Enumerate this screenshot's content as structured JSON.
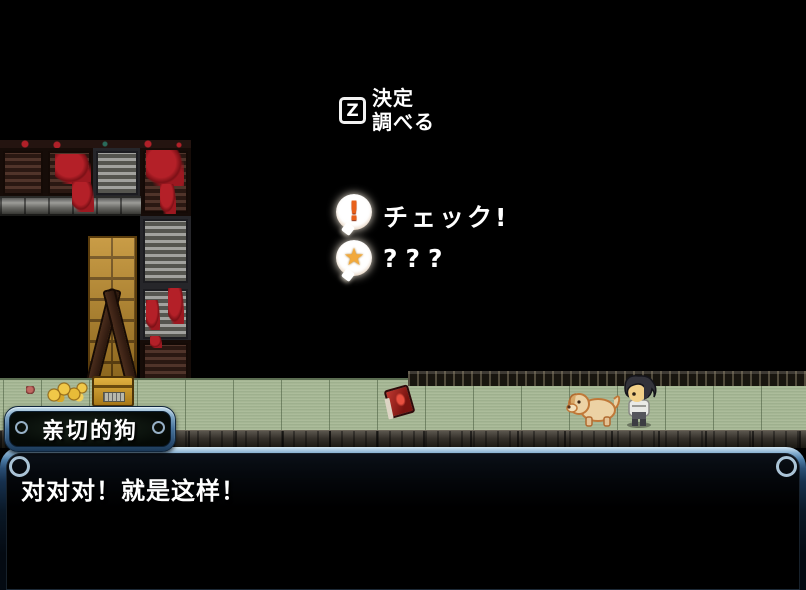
{
  "tutorial": {
    "key": "Z",
    "line1": "決定",
    "line2": "調べる"
  },
  "bubbles": {
    "check": {
      "icon": "exclamation-icon",
      "glyph": "!",
      "label": "チェック!"
    },
    "mystery": {
      "icon": "star-icon",
      "glyph": "★",
      "label": "???"
    }
  },
  "dialogue": {
    "speaker": "亲切的狗",
    "text": "对对对！就是这样！"
  },
  "scene": {
    "colors": {
      "floor_green": "#a8b996",
      "window_frame_light": "#bcd8ec",
      "window_frame_dark": "#1c3a58",
      "blood_red": "#a81c20",
      "brick_gold": "#c08c28",
      "exclaim_orange": "#e8601a",
      "star_gold": "#f2a93b"
    }
  }
}
